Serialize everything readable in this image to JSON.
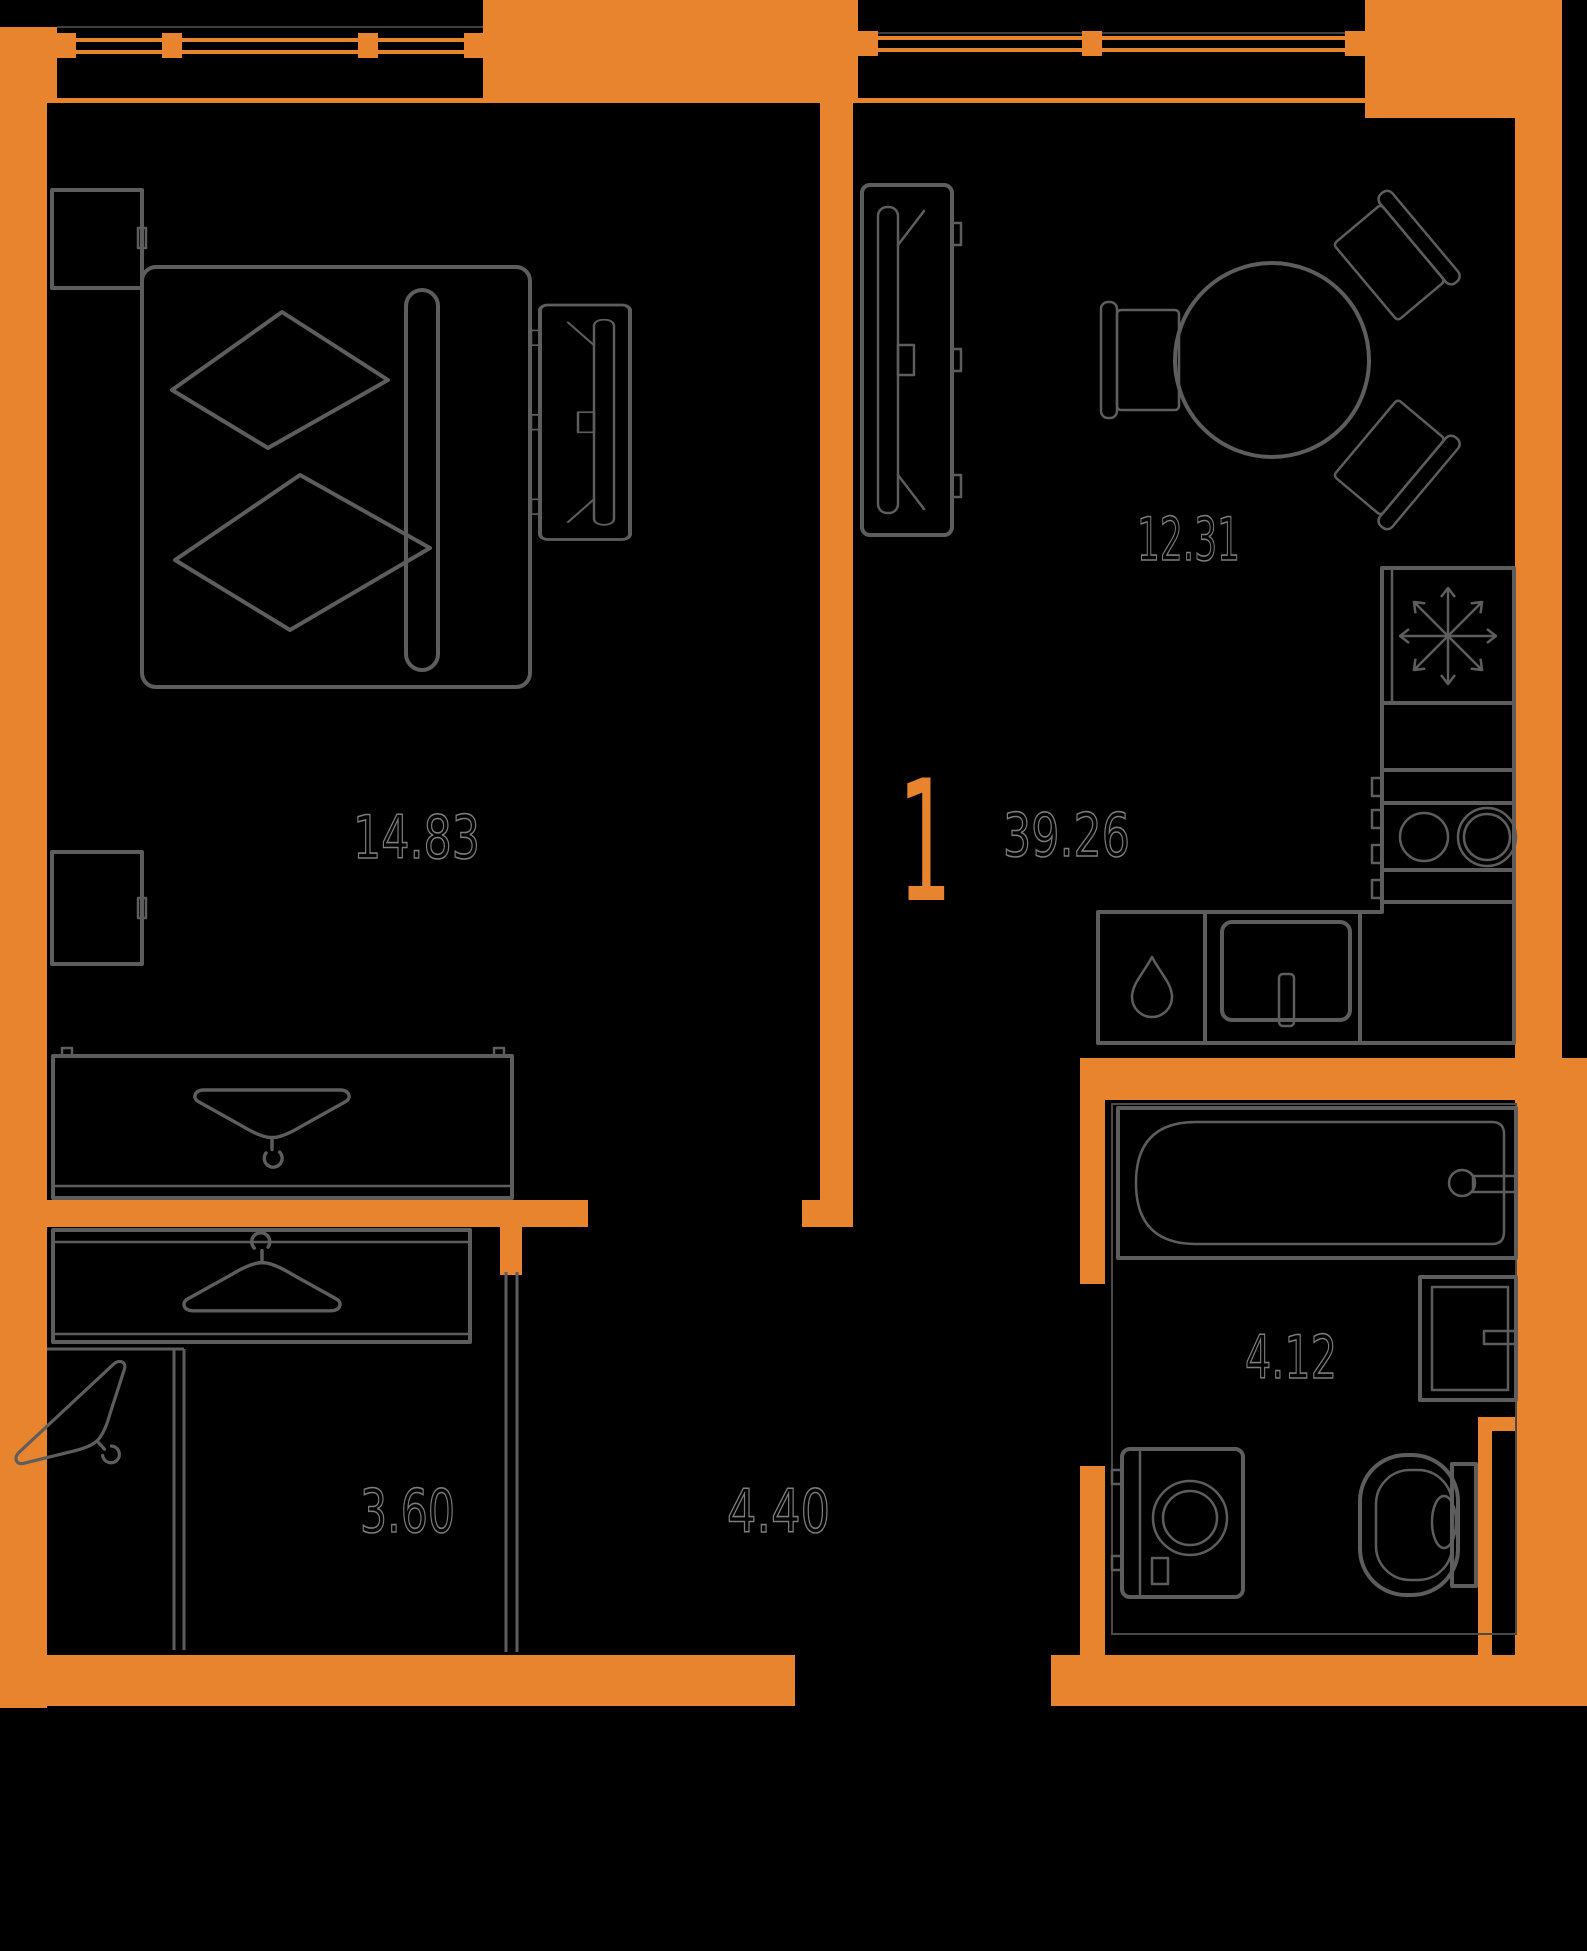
{
  "plan": {
    "title": "1-room apartment floor plan",
    "unit_number": "1",
    "total_area": "39.26",
    "colors": {
      "wall": "#E8842E",
      "background": "#000000",
      "furniture_line": "#5D5D5D",
      "area_label": "#7C7C7C"
    },
    "rooms": [
      {
        "name": "bedroom",
        "area": "14.83"
      },
      {
        "name": "kitchen-living",
        "area": "12.31"
      },
      {
        "name": "bathroom",
        "area": "4.12"
      },
      {
        "name": "closet",
        "area": "3.60"
      },
      {
        "name": "hallway",
        "area": "4.40"
      }
    ]
  }
}
